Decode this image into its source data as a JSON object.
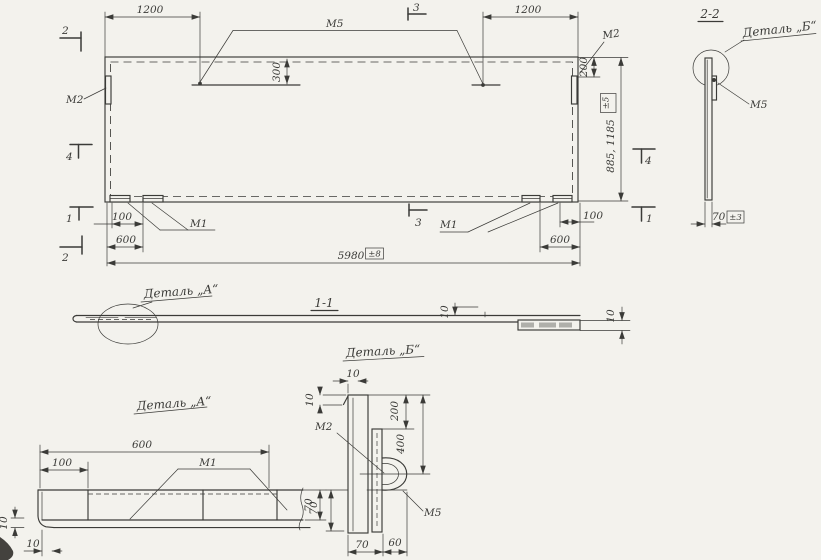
{
  "colors": {
    "paper": "#f3f2ed",
    "ink": "#3b3b38",
    "shade": "#8b8b85",
    "blob": "#44423e"
  },
  "main_view": {
    "dim_1200_left": "1200",
    "dim_1200_right": "1200",
    "label_m5": "М5",
    "dim_300": "300",
    "marker_2_top": "2",
    "marker_2_bottom": "2",
    "marker_3_top": "3",
    "marker_3_bottom": "3",
    "marker_4_left": "4",
    "marker_4_right": "4",
    "marker_1_left": "1",
    "marker_1_right": "1",
    "label_m2_left": "М2",
    "label_m2_right": "М2",
    "dim_200": "200",
    "tol_height": "±5",
    "dim_height": "885, 1185",
    "label_m1_left": "М1",
    "label_m1_right": "М1",
    "dim_100_left": "100",
    "dim_600_left": "600",
    "dim_100_right": "100",
    "dim_600_right": "600",
    "dim_length": "5980",
    "tol_length": "±8"
  },
  "section_2_2": {
    "title": "2-2",
    "detail_label": "Деталь „Б“",
    "label_m5": "М5",
    "dim_70": "70",
    "tol_70": "±3"
  },
  "section_1_1": {
    "title": "1-1",
    "detail_label": "Деталь „А“",
    "dim_10_mid": "10",
    "dim_10_end": "10"
  },
  "detail_a": {
    "title": "Деталь „А“",
    "dim_600": "600",
    "dim_100": "100",
    "label_m1": "М1",
    "dim_70": "70",
    "dim_10_thickness": "10",
    "dim_10_offset": "10"
  },
  "detail_b": {
    "title": "Деталь „Б“",
    "dim_10_top": "10",
    "dim_10_left": "10",
    "label_m2": "М2",
    "label_m5": "М5",
    "dim_200": "200",
    "dim_400": "400",
    "dim_70_left": "70",
    "dim_70_bottom": "70",
    "dim_60": "60"
  }
}
